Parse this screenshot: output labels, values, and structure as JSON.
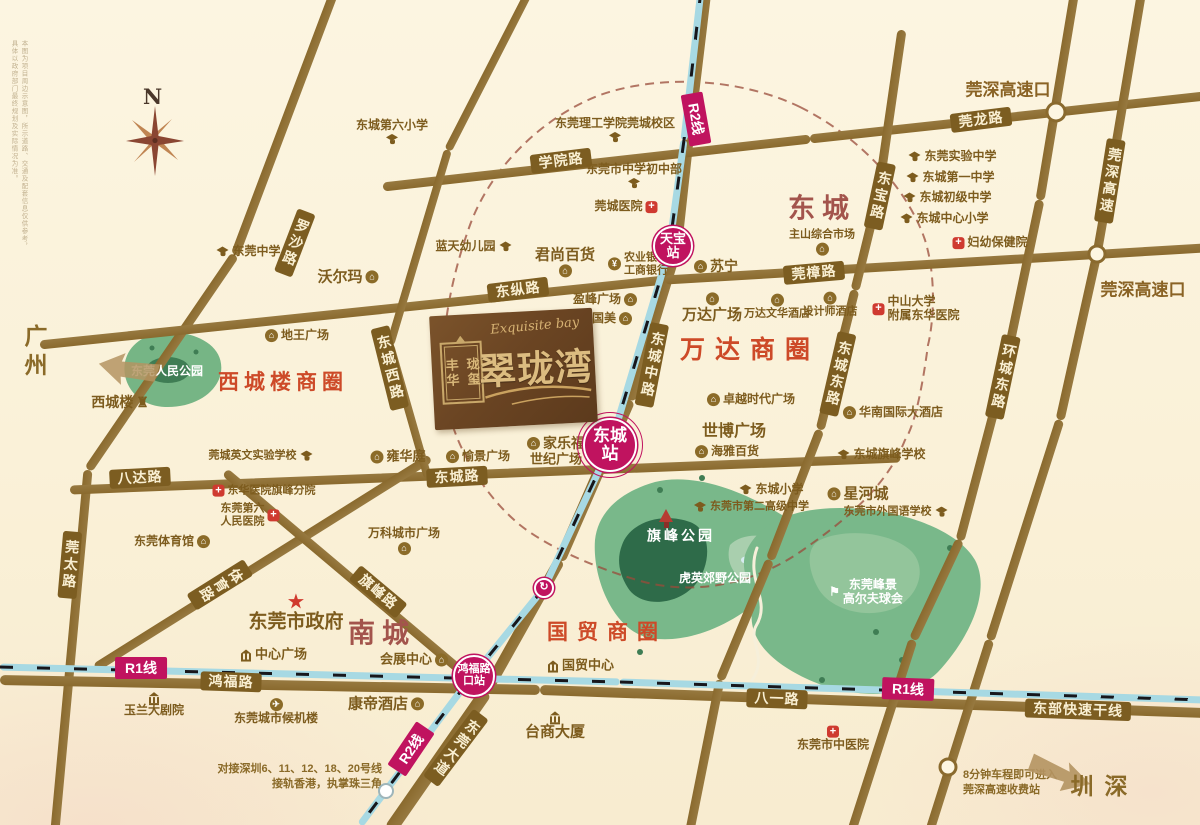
{
  "map": {
    "compass_n": "N",
    "disclaimer": "本图为项目周边示意图，所示道路、交通及配套信息仅供参考，具体以政府部门最终规划及实际情况为准。",
    "logo": {
      "seal_col1": "丰华",
      "seal_col2": "珑玺",
      "script": "Exquisite bay",
      "name": "翠珑湾"
    },
    "colors": {
      "accent_magenta": "#c0135f",
      "road_brown": "#8a6a2e",
      "circle_red": "#cd4a28",
      "district_red": "#a3544c",
      "park_green": "#79b88a"
    },
    "city_arrows": [
      {
        "label": "广州",
        "x": 34,
        "y": 353
      },
      {
        "label": "深圳",
        "x": 1097,
        "y": 791
      }
    ],
    "districts": [
      {
        "label": "东城",
        "x": 822,
        "y": 206,
        "size": 27
      },
      {
        "label": "南城",
        "x": 382,
        "y": 631,
        "size": 27
      }
    ],
    "business_circles": [
      {
        "label": "西城楼商圈",
        "x": 283,
        "y": 381,
        "size": 21,
        "ls": 5
      },
      {
        "label": "万达商圈",
        "x": 750,
        "y": 348,
        "size": 25,
        "ls": 10
      },
      {
        "label": "国贸商圈",
        "x": 607,
        "y": 631,
        "size": 21,
        "ls": 9
      }
    ],
    "highway_exits": [
      {
        "label": "莞深高速口",
        "x": 1008,
        "y": 88
      },
      {
        "label": "莞深高速口",
        "x": 1143,
        "y": 288
      }
    ],
    "road_labels": [
      {
        "t": "罗沙路",
        "x": 295,
        "y": 243,
        "rot": 21,
        "v": 1
      },
      {
        "t": "学院路",
        "x": 561,
        "y": 161,
        "rot": -7
      },
      {
        "t": "莞龙路",
        "x": 981,
        "y": 120,
        "rot": -7
      },
      {
        "t": "东纵路",
        "x": 518,
        "y": 290,
        "rot": -7
      },
      {
        "t": "莞樟路",
        "x": 814,
        "y": 273,
        "rot": -5
      },
      {
        "t": "东宝路",
        "x": 880,
        "y": 196,
        "rot": 12,
        "v": 1
      },
      {
        "t": "莞深高速",
        "x": 1110,
        "y": 181,
        "rot": 9,
        "v": 1
      },
      {
        "t": "东城西路",
        "x": 390,
        "y": 368,
        "rot": -14,
        "v": 1
      },
      {
        "t": "东城中路",
        "x": 652,
        "y": 365,
        "rot": 11,
        "v": 1
      },
      {
        "t": "东城东路",
        "x": 838,
        "y": 374,
        "rot": 13,
        "v": 1
      },
      {
        "t": "环城东路",
        "x": 1003,
        "y": 377,
        "rot": 12,
        "v": 1
      },
      {
        "t": "八达路",
        "x": 140,
        "y": 478,
        "rot": -3
      },
      {
        "t": "东城路",
        "x": 457,
        "y": 477,
        "rot": -3
      },
      {
        "t": "莞太路",
        "x": 70,
        "y": 565,
        "rot": 5,
        "v": 1
      },
      {
        "t": "体育路",
        "x": 220,
        "y": 585,
        "rot": 58,
        "v": 1
      },
      {
        "t": "旗峰路",
        "x": 378,
        "y": 592,
        "rot": 40
      },
      {
        "t": "鸿福路",
        "x": 231,
        "y": 682,
        "rot": 2
      },
      {
        "t": "八一路",
        "x": 777,
        "y": 699,
        "rot": 2
      },
      {
        "t": "东部快速干线",
        "x": 1078,
        "y": 710,
        "rot": 2
      },
      {
        "t": "东莞大道",
        "x": 456,
        "y": 748,
        "rot": 37,
        "v": 1
      }
    ],
    "metro": {
      "line_labels": [
        {
          "t": "R2线",
          "x": 696,
          "y": 119,
          "rot": 80
        },
        {
          "t": "R2线",
          "x": 411,
          "y": 749,
          "rot": -56
        },
        {
          "t": "R1线",
          "x": 141,
          "y": 668,
          "rot": 0
        },
        {
          "t": "R1线",
          "x": 908,
          "y": 689,
          "rot": 2
        }
      ],
      "stations": [
        {
          "name": "天宝站",
          "x": 673,
          "y": 246,
          "r": 20,
          "fs": 13
        },
        {
          "name": "东城站",
          "x": 610,
          "y": 445,
          "r": 27,
          "fs": 17,
          "ring": 1
        },
        {
          "name": "鸿福路",
          "l2": "口站",
          "x": 474,
          "y": 676,
          "r": 21,
          "fs": 11
        },
        {
          "type": "mini",
          "name": "↻",
          "x": 544,
          "y": 588,
          "r": 10
        },
        {
          "type": "dot",
          "x": 386,
          "y": 791,
          "r": 8
        }
      ]
    },
    "parks": [
      {
        "t": "东莞人民公园",
        "x": 167,
        "y": 371,
        "s": 12
      },
      {
        "t": "旗峰公园",
        "x": 681,
        "y": 536,
        "s": 14,
        "ls": 3
      },
      {
        "t": "虎英郊野公园",
        "x": 715,
        "y": 578,
        "s": 12
      },
      {
        "t": "东莞峰景",
        "l2": "高尔夫球会",
        "x": 866,
        "y": 592,
        "s": 12,
        "flag": 1
      }
    ],
    "pois": [
      {
        "t": "东城第六小学",
        "x": 392,
        "y": 132,
        "i": "school",
        "p": "b"
      },
      {
        "t": "东莞理工学院莞城校区",
        "x": 615,
        "y": 130,
        "i": "school",
        "p": "b"
      },
      {
        "t": "东莞市中学初中部",
        "x": 634,
        "y": 176,
        "i": "school",
        "p": "b"
      },
      {
        "t": "莞城医院",
        "x": 626,
        "y": 207,
        "i": "hospital",
        "p": "r"
      },
      {
        "t": "蓝天幼儿园",
        "x": 474,
        "y": 247,
        "i": "school",
        "p": "r"
      },
      {
        "t": "东莞中学",
        "x": 248,
        "y": 252,
        "i": "school",
        "p": "l"
      },
      {
        "t": "沃尔玛",
        "x": 348,
        "y": 277,
        "i": "shop",
        "p": "r",
        "s": 15
      },
      {
        "t": "君尚百货",
        "x": 565,
        "y": 262,
        "i": "shop",
        "p": "b",
        "s": 15
      },
      {
        "t": "农业银行",
        "l2": "工商银行",
        "x": 638,
        "y": 264,
        "i": "bank",
        "p": "l",
        "s": 11
      },
      {
        "t": "苏宁",
        "x": 716,
        "y": 266,
        "i": "shop",
        "p": "l",
        "s": 14
      },
      {
        "t": "盈峰广场",
        "x": 605,
        "y": 300,
        "i": "shop",
        "p": "r"
      },
      {
        "t": "国美",
        "x": 612,
        "y": 319,
        "i": "shop",
        "p": "r"
      },
      {
        "t": "万达广场",
        "x": 712,
        "y": 308,
        "i": "shop",
        "p": "a",
        "s": 15
      },
      {
        "t": "万达文华酒店",
        "x": 777,
        "y": 307,
        "i": "shop",
        "p": "a",
        "s": 11
      },
      {
        "t": "设计师酒店",
        "x": 830,
        "y": 305,
        "i": "shop",
        "p": "a",
        "s": 11
      },
      {
        "t": "主山综合市场",
        "x": 822,
        "y": 242,
        "i": "shop",
        "p": "b",
        "s": 11
      },
      {
        "t": "东莞实验中学",
        "x": 952,
        "y": 157,
        "i": "school",
        "p": "l"
      },
      {
        "t": "东城第一中学",
        "x": 950,
        "y": 178,
        "i": "school",
        "p": "l"
      },
      {
        "t": "东城初级中学",
        "x": 947,
        "y": 198,
        "i": "school",
        "p": "l"
      },
      {
        "t": "东城中心小学",
        "x": 944,
        "y": 219,
        "i": "school",
        "p": "l"
      },
      {
        "t": "妇幼保健院",
        "x": 990,
        "y": 243,
        "i": "hospital",
        "p": "l"
      },
      {
        "t": "中山大学",
        "l2": "附属东华医院",
        "x": 916,
        "y": 309,
        "i": "hospital",
        "p": "l",
        "align": "left"
      },
      {
        "t": "华南国际大酒店",
        "x": 893,
        "y": 413,
        "i": "shop",
        "p": "l"
      },
      {
        "t": "东城旗峰学校",
        "x": 881,
        "y": 455,
        "i": "school",
        "p": "l"
      },
      {
        "t": "星河城",
        "x": 858,
        "y": 494,
        "i": "shop",
        "p": "l",
        "s": 15
      },
      {
        "t": "东莞市外国语学校",
        "x": 896,
        "y": 512,
        "i": "school",
        "p": "r",
        "s": 11
      },
      {
        "t": "东城小学",
        "x": 771,
        "y": 490,
        "i": "school",
        "p": "l"
      },
      {
        "t": "东莞市第二高级中学",
        "x": 751,
        "y": 507,
        "i": "school",
        "p": "l",
        "s": 11
      },
      {
        "t": "世博广场",
        "x": 734,
        "y": 432,
        "s": 16
      },
      {
        "t": "海雅百货",
        "x": 727,
        "y": 452,
        "i": "shop",
        "p": "l"
      },
      {
        "t": "卓越时代广场",
        "x": 751,
        "y": 400,
        "i": "shop",
        "p": "l"
      },
      {
        "t": "西城楼",
        "x": 120,
        "y": 402,
        "i": "tower",
        "p": "r",
        "s": 14
      },
      {
        "t": "地王广场",
        "x": 297,
        "y": 336,
        "i": "shop",
        "p": "l"
      },
      {
        "t": "莞城英文实验学校",
        "x": 261,
        "y": 456,
        "i": "school",
        "p": "r",
        "s": 11
      },
      {
        "t": "雍华庭",
        "x": 398,
        "y": 457,
        "i": "shop",
        "p": "l",
        "s": 13
      },
      {
        "t": "愉景广场",
        "x": 478,
        "y": 457,
        "i": "shop",
        "p": "l"
      },
      {
        "t": "家乐福",
        "x": 556,
        "y": 443,
        "i": "shop",
        "p": "l",
        "s": 14
      },
      {
        "t": "世纪广场",
        "x": 556,
        "y": 460,
        "s": 13
      },
      {
        "t": "万科城市广场",
        "x": 404,
        "y": 541,
        "i": "shop",
        "p": "b"
      },
      {
        "t": "东莞体育馆",
        "x": 172,
        "y": 542,
        "i": "shop",
        "p": "r"
      },
      {
        "t": "东华医院旗峰分院",
        "x": 264,
        "y": 491,
        "i": "hospital",
        "p": "l",
        "s": 11
      },
      {
        "t": "东莞第六",
        "l2": "人民医院",
        "x": 250,
        "y": 515,
        "i": "hospital",
        "p": "r",
        "s": 11
      },
      {
        "t": "东莞市政府",
        "x": 296,
        "y": 613,
        "i": "star",
        "p": "a",
        "s": 19
      },
      {
        "t": "中心广场",
        "x": 273,
        "y": 655,
        "i": "civic",
        "p": "l",
        "s": 13
      },
      {
        "t": "玉兰大剧院",
        "x": 154,
        "y": 705,
        "i": "civic",
        "p": "a"
      },
      {
        "t": "东莞城市候机楼",
        "x": 276,
        "y": 712,
        "i": "plane",
        "p": "a"
      },
      {
        "t": "康帝酒店",
        "x": 386,
        "y": 704,
        "i": "shop",
        "p": "r",
        "s": 15
      },
      {
        "t": "会展中心",
        "x": 414,
        "y": 660,
        "i": "shop",
        "p": "r",
        "s": 13
      },
      {
        "t": "国贸中心",
        "x": 580,
        "y": 666,
        "i": "civic",
        "p": "l",
        "s": 13
      },
      {
        "t": "台商大厦",
        "x": 555,
        "y": 726,
        "i": "civic",
        "p": "a",
        "s": 15
      },
      {
        "t": "东莞市中医院",
        "x": 833,
        "y": 739,
        "i": "hospital",
        "p": "a"
      }
    ],
    "notes": [
      {
        "lines": [
          "对接深圳6、11、12、18、20号线",
          "接轨香港，执掌珠三角"
        ],
        "x": 382,
        "y": 762,
        "align": "right"
      },
      {
        "lines": [
          "8分钟车程即可进入",
          "莞深高速收费站"
        ],
        "x": 963,
        "y": 768,
        "align": "left"
      }
    ]
  }
}
